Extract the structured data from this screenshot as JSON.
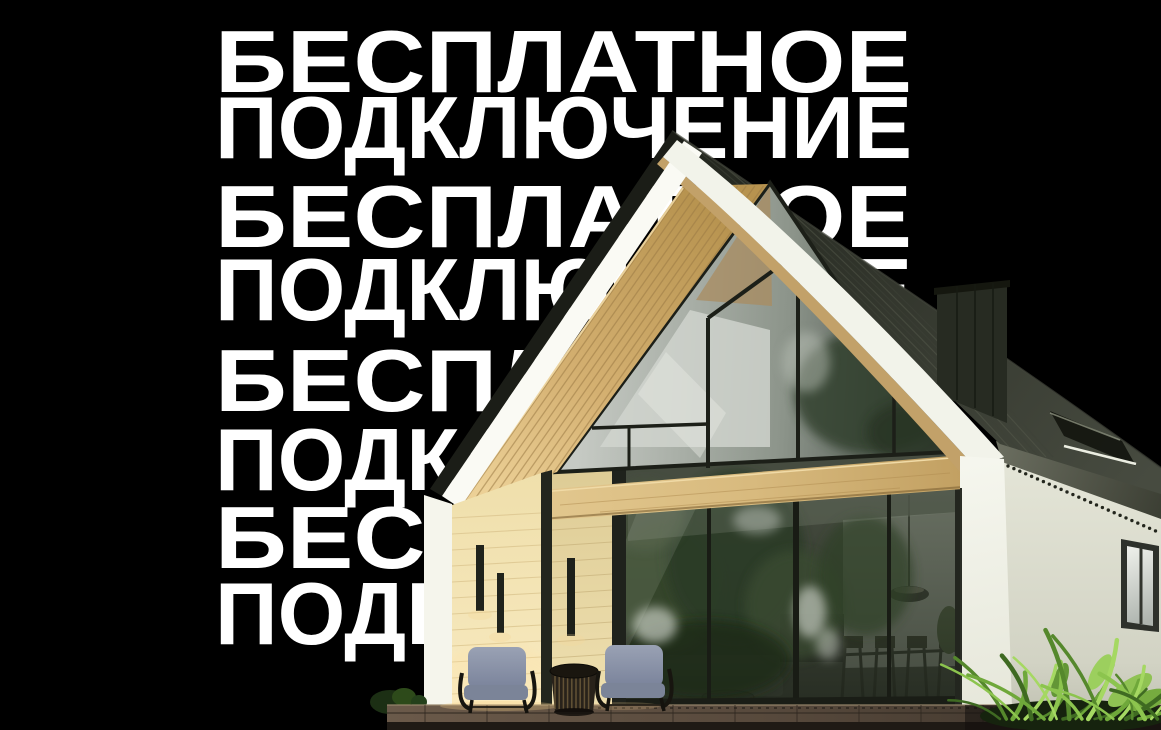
{
  "background_text": {
    "rows": [
      {
        "label": "БЕСПЛАТНОЕ"
      },
      {
        "label": "ПОДКЛЮЧЕНИЕ"
      },
      {
        "label": "БЕСПЛАТНОЕ"
      },
      {
        "label": "ПОДКЛЮЧЕНИЕ"
      },
      {
        "label": "БЕСПЛАТНОЕ"
      },
      {
        "label": "ПОДКЛЮЧЕНИЕ"
      },
      {
        "label": "БЕСПЛАТНОЕ"
      },
      {
        "label": "ПОДКЛЮЧЕНИЕ"
      }
    ]
  },
  "palette": {
    "background": "#000000",
    "text": "#ffffff",
    "roof_dark": "#2a2d25",
    "fascia_white": "#f7f7f0",
    "soffit_wood": "#cdab6e",
    "siding_cream": "#f3e4b4",
    "glass_reflection": "#3f4737",
    "deck_wood": "#50443a",
    "foliage_green": "#6fa83a",
    "side_wall": "#dfe0d2"
  }
}
